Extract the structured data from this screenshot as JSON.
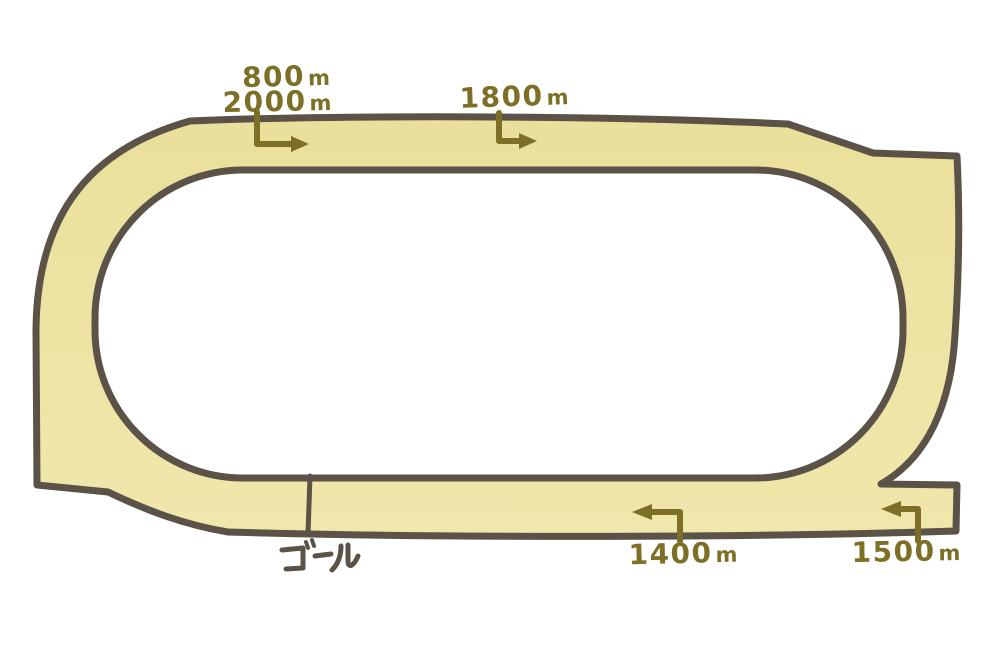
{
  "illustration": {
    "kind": "racecourse-diagram",
    "background_color": "#ffffff",
    "track_fill_color": "#ece3a1",
    "track_outline_color": "#5b5248",
    "marker_text_color": "#7d7026",
    "finish_line_color": "#5b5248"
  },
  "distance_markers": [
    {
      "value": "800",
      "unit": "m",
      "arrow_direction": "right",
      "location": "top-straight-start"
    },
    {
      "value": "2000",
      "unit": "m",
      "arrow_direction": "right",
      "location": "top-straight-start"
    },
    {
      "value": "1800",
      "unit": "m",
      "arrow_direction": "right",
      "location": "top-straight-middle"
    },
    {
      "value": "1400",
      "unit": "m",
      "arrow_direction": "left",
      "location": "bottom-straight-middle"
    },
    {
      "value": "1500",
      "unit": "m",
      "arrow_direction": "left",
      "location": "bottom-right-chute"
    }
  ],
  "finish": {
    "label": "ゴール"
  }
}
